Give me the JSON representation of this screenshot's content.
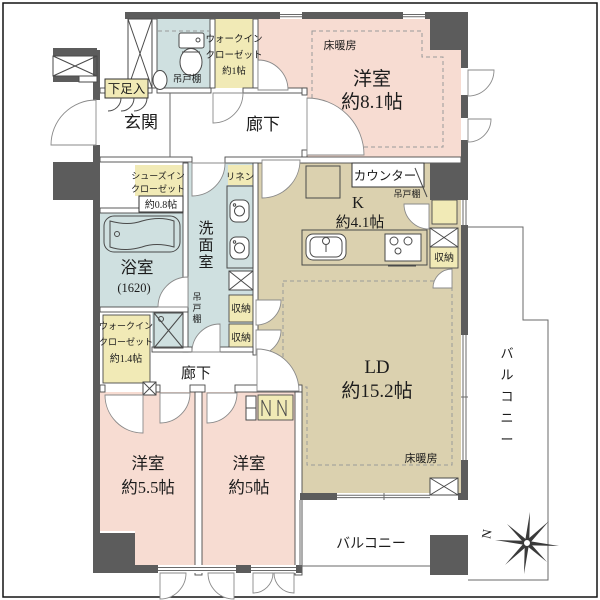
{
  "title": "マンション間取り図",
  "palette": {
    "structural_wall": "#5c5c5c",
    "bedroom_pink": "#f7dcd2",
    "ldk_tan": "#dbd1af",
    "wet_area_blue": "#cfe0e0",
    "closet_yellow": "#f1eab6",
    "line": "#4a4a4a",
    "floor_heating_dash": "#9a9a9a"
  },
  "labels": {
    "shoe_box": "下足入",
    "genkan": "玄関",
    "tsuridana": "吊戸棚",
    "walkin": "ウォークイン",
    "closet": "クローゼット",
    "wic1_size": "約1帖",
    "yuka_danbou": "床暖房",
    "yoshitsu": "洋室",
    "bed81_size": "約8.1帖",
    "rouka": "廊下",
    "counter": "カウンター",
    "k": "K",
    "k_size": "約4.1帖",
    "shoesin": "シューズイン",
    "sic_size": "約0.8帖",
    "linen": "リネン",
    "senmen": "洗面室",
    "yokushitsu": "浴室",
    "yokushitsu_size": "(1620)",
    "shuno": "収納",
    "wic14_size": "約1.4帖",
    "bed55_size": "約5.5帖",
    "bed5_size": "約5帖",
    "ld": "LD",
    "ld_size": "約15.2帖",
    "balcony": "バルコニー",
    "north": "N"
  }
}
